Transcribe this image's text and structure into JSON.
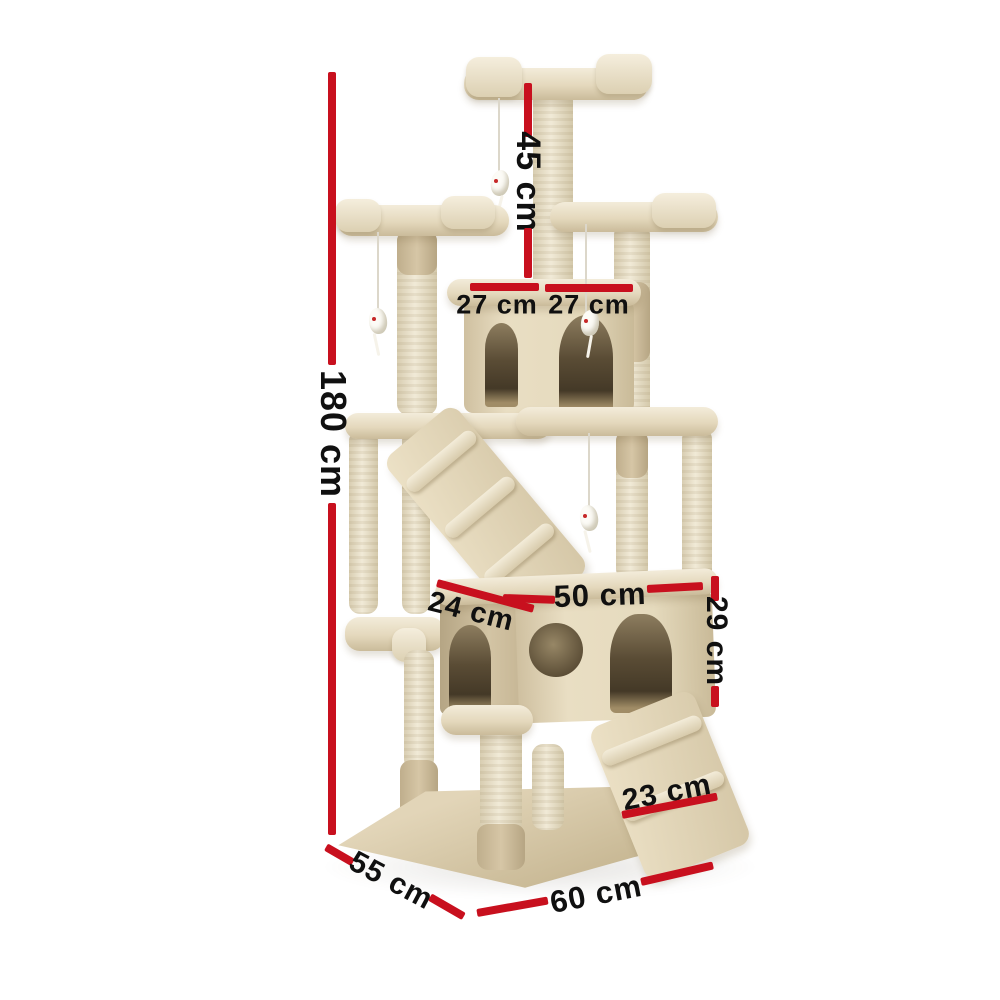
{
  "meta": {
    "description": "Cat tree scratching post product photo with dimension annotations",
    "background": "#ffffff"
  },
  "colors": {
    "annotation": "#c8101e",
    "text": "#101010"
  },
  "labels": {
    "total_height": "180 cm",
    "top_post_height": "45 cm",
    "top_perch_left_width": "27 cm",
    "top_perch_right_width": "27 cm",
    "condo_depth": "24 cm",
    "condo_width": "50 cm",
    "condo_height": "29 cm",
    "ramp_width": "23 cm",
    "base_depth": "55 cm",
    "base_width": "60 cm"
  }
}
